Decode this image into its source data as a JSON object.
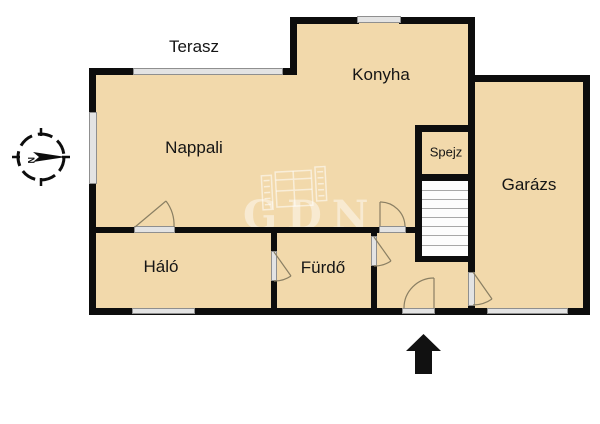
{
  "plan": {
    "type": "floorplan",
    "rooms": [
      {
        "id": "terasz",
        "label": "Terasz"
      },
      {
        "id": "nappali",
        "label": "Nappali"
      },
      {
        "id": "konyha",
        "label": "Konyha"
      },
      {
        "id": "spejz",
        "label": "Spejz"
      },
      {
        "id": "garazs",
        "label": "Garázs"
      },
      {
        "id": "halo",
        "label": "Háló"
      },
      {
        "id": "furdo",
        "label": "Fürdő"
      }
    ],
    "watermark": {
      "text": "GDN",
      "icon": "film-logo-icon"
    },
    "compass": {
      "letter": "N",
      "icon": "compass-rose-icon",
      "direction": "right"
    },
    "entrance": {
      "icon": "arrow-up-icon"
    },
    "colors": {
      "floor_fill": "#f2d9ab",
      "wall": "#0d0d0d",
      "window_fill": "#e3e3e3",
      "window_border": "#8f8f8f",
      "door_arc": "#8a7f63",
      "background": "#ffffff"
    }
  }
}
